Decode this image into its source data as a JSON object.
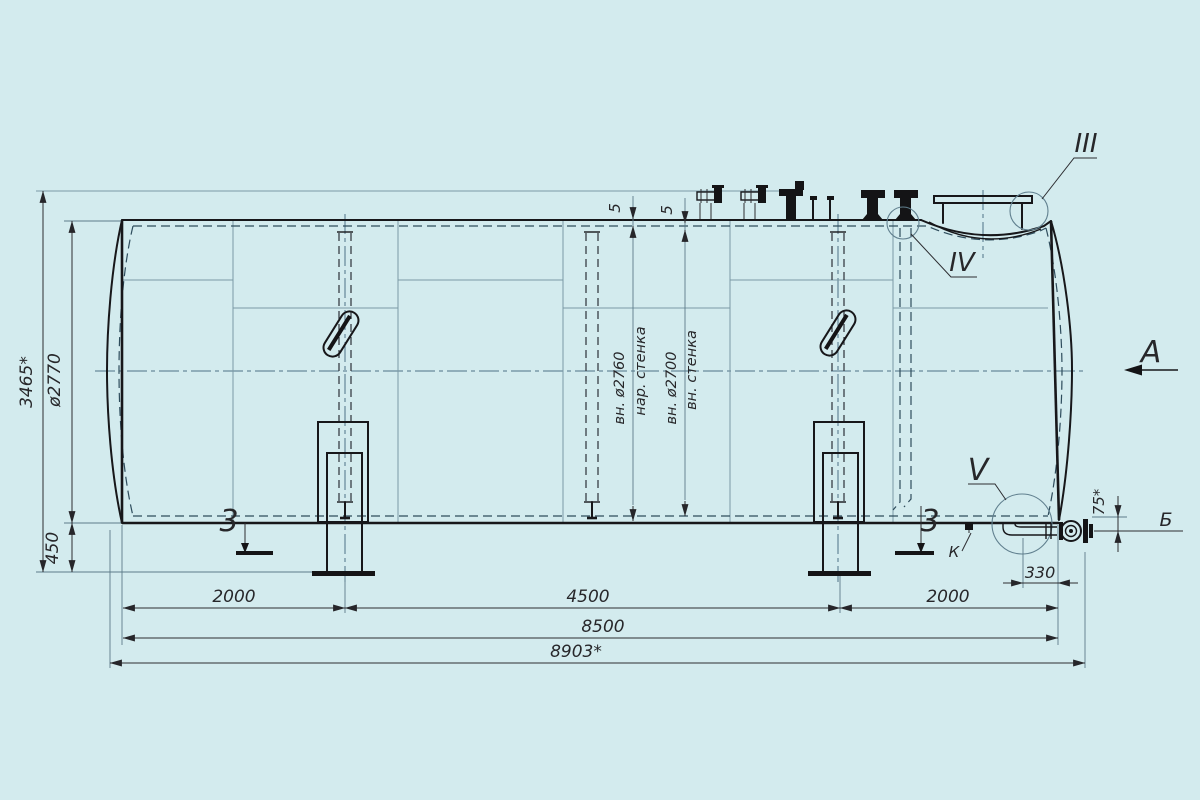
{
  "drawing": {
    "type": "engineering-drawing",
    "subject": "horizontal double-wall cylindrical tank, side view",
    "background_color": "#d3ebee",
    "line_color": "#17171a",
    "thin_line_color": "#7b99a5",
    "dims": {
      "overall_height": "3465*",
      "shell_diameter": "ø2770",
      "ground_clearance": "450",
      "left_span": "2000",
      "center_span": "4500",
      "right_span": "2000",
      "shell_length": "8500",
      "overall_length": "8903*",
      "drain_offset": "330",
      "drain_height": "75*",
      "wall_thk_outer": "5",
      "wall_thk_inner": "5"
    },
    "annotations": {
      "outer_wall_dia": "вн. ø2760",
      "outer_wall_label": "нар. стенка",
      "inner_wall_dia": "вн. ø2700",
      "inner_wall_label": "вн. стенка"
    },
    "callouts": {
      "detail_3": "III",
      "detail_4": "IV",
      "detail_5": "V",
      "view_a": "A",
      "axis_b": "Б",
      "item_k": "К",
      "section_left": "3",
      "section_right": "3"
    }
  }
}
